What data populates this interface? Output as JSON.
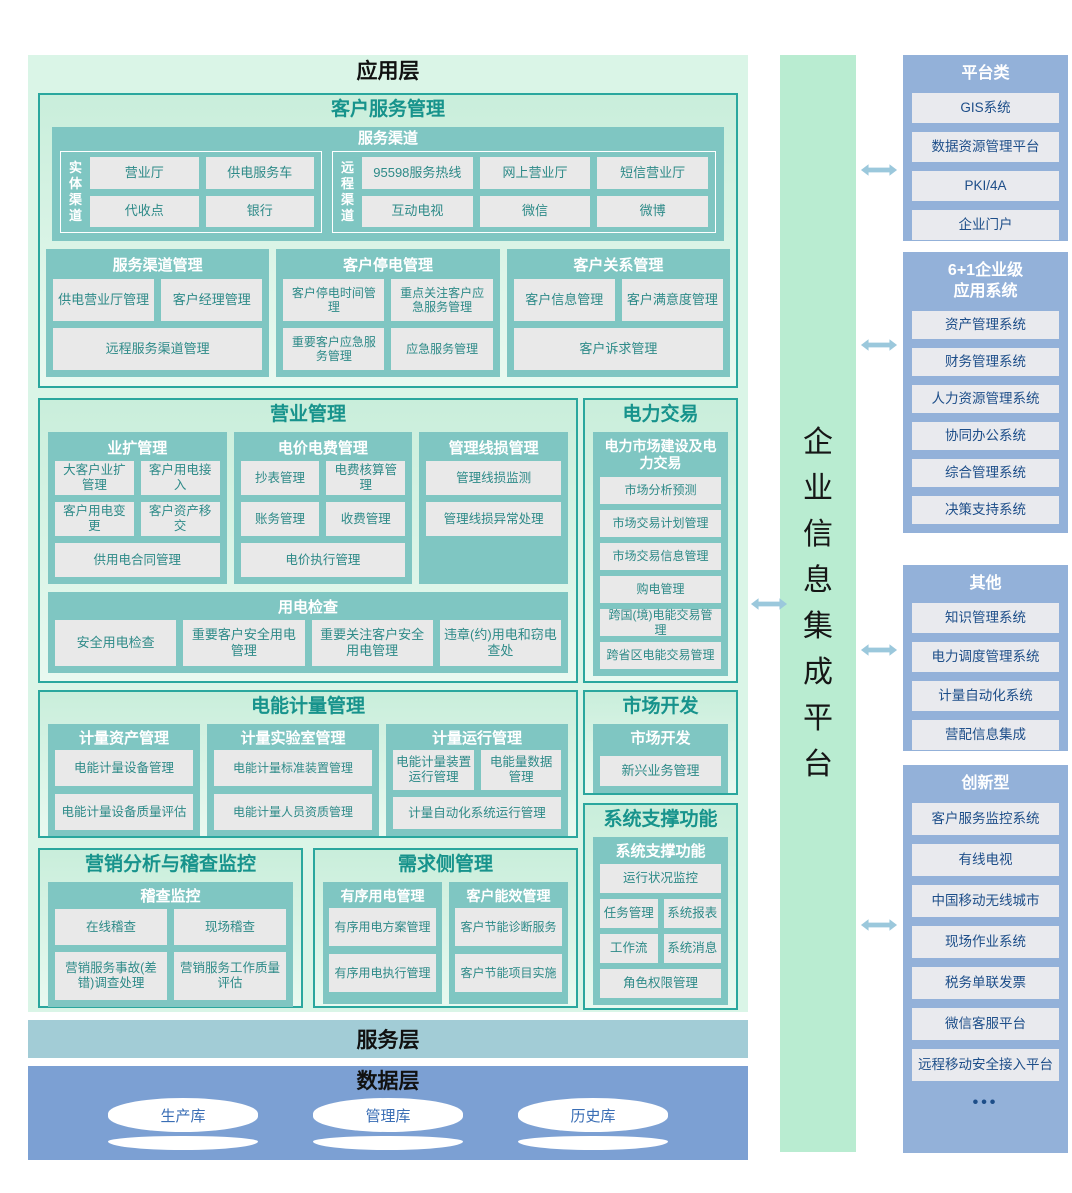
{
  "colors": {
    "accent_teal": "#7fc6c2",
    "section_border": "#2aa79e",
    "section_title": "#17938c",
    "leaf_bg": "#e9e9e9",
    "leaf_text": "#2d8a88",
    "platform_bar_green": "#b9ecd1",
    "right_panel_blue": "#93b1d9",
    "right_leaf_text": "#1d4e89",
    "service_layer_bg": "#a2ccd6",
    "data_layer_bg": "#7ca0d3",
    "arrow_blue": "#9bc8dc"
  },
  "app_layer": {
    "title": "应用层"
  },
  "customer_service": {
    "title": "客户服务管理",
    "service_channel": {
      "title": "服务渠道",
      "physical": {
        "label": "实体渠道",
        "items": [
          "营业厅",
          "供电服务车",
          "代收点",
          "银行"
        ]
      },
      "remote": {
        "label": "远程渠道",
        "items": [
          "95598服务热线",
          "网上营业厅",
          "短信营业厅",
          "互动电视",
          "微信",
          "微博"
        ]
      }
    },
    "channel_mgmt": {
      "title": "服务渠道管理",
      "items": [
        "供电营业厅管理",
        "客户经理管理",
        "远程服务渠道管理"
      ]
    },
    "outage_mgmt": {
      "title": "客户停电管理",
      "items": [
        "客户停电时间管理",
        "重点关注客户应急服务管理",
        "重要客户应急服务管理",
        "应急服务管理"
      ]
    },
    "crm": {
      "title": "客户关系管理",
      "items": [
        "客户信息管理",
        "客户满意度管理",
        "客户诉求管理"
      ]
    }
  },
  "business_mgmt": {
    "title": "营业管理",
    "expansion": {
      "title": "业扩管理",
      "items": [
        "大客户业扩管理",
        "客户用电接入",
        "客户用电变更",
        "客户资产移交",
        "供用电合同管理"
      ]
    },
    "tariff": {
      "title": "电价电费管理",
      "items": [
        "抄表管理",
        "电费核算管理",
        "账务管理",
        "收费管理",
        "电价执行管理"
      ]
    },
    "line_loss": {
      "title": "管理线损管理",
      "items": [
        "管理线损监测",
        "管理线损异常处理"
      ]
    },
    "inspection": {
      "title": "用电检查",
      "items": [
        "安全用电检查",
        "重要客户安全用电管理",
        "重要关注客户安全用电管理",
        "违章(约)用电和窃电查处"
      ]
    }
  },
  "power_trading": {
    "title": "电力交易",
    "group": {
      "title": "电力市场建设及电力交易",
      "items": [
        "市场分析预测",
        "市场交易计划管理",
        "市场交易信息管理",
        "购电管理",
        "跨国(境)电能交易管理",
        "跨省区电能交易管理"
      ]
    }
  },
  "metering": {
    "title": "电能计量管理",
    "asset": {
      "title": "计量资产管理",
      "items": [
        "电能计量设备管理",
        "电能计量设备质量评估"
      ]
    },
    "lab": {
      "title": "计量实验室管理",
      "items": [
        "电能计量标准装置管理",
        "电能计量人员资质管理"
      ]
    },
    "operation": {
      "title": "计量运行管理",
      "items": [
        "电能计量装置运行管理",
        "电能量数据管理",
        "计量自动化系统运行管理"
      ]
    }
  },
  "market_dev": {
    "title": "市场开发",
    "group": {
      "title": "市场开发",
      "items": [
        "新兴业务管理"
      ]
    }
  },
  "system_support": {
    "title": "系统支撑功能",
    "group": {
      "title": "系统支撑功能",
      "items": [
        "运行状况监控",
        "任务管理",
        "系统报表",
        "工作流",
        "系统消息",
        "角色权限管理"
      ]
    }
  },
  "marketing_analysis": {
    "title": "营销分析与稽查监控",
    "group": {
      "title": "稽查监控",
      "items": [
        "在线稽查",
        "现场稽查",
        "营销服务事故(差错)调查处理",
        "营销服务工作质量评估"
      ]
    }
  },
  "demand_side": {
    "title": "需求侧管理",
    "orderly": {
      "title": "有序用电管理",
      "items": [
        "有序用电方案管理",
        "有序用电执行管理"
      ]
    },
    "efficiency": {
      "title": "客户能效管理",
      "items": [
        "客户节能诊断服务",
        "客户节能项目实施"
      ]
    }
  },
  "service_layer": {
    "title": "服务层"
  },
  "data_layer": {
    "title": "数据层",
    "databases": [
      "生产库",
      "管理库",
      "历史库"
    ]
  },
  "integration_platform": {
    "title": "企业信息集成平台"
  },
  "right_panel": {
    "platform": {
      "title": "平台类",
      "items": [
        "GIS系统",
        "数据资源管理平台",
        "PKI/4A",
        "企业门户"
      ]
    },
    "enterprise": {
      "title": "6+1企业级\n应用系统",
      "items": [
        "资产管理系统",
        "财务管理系统",
        "人力资源管理系统",
        "协同办公系统",
        "综合管理系统",
        "决策支持系统"
      ]
    },
    "other": {
      "title": "其他",
      "items": [
        "知识管理系统",
        "电力调度管理系统",
        "计量自动化系统",
        "营配信息集成"
      ]
    },
    "innovative": {
      "title": "创新型",
      "items": [
        "客户服务监控系统",
        "有线电视",
        "中国移动无线城市",
        "现场作业系统",
        "税务单联发票",
        "微信客服平台",
        "远程移动安全接入平台"
      ],
      "ellipsis": "•••"
    }
  }
}
